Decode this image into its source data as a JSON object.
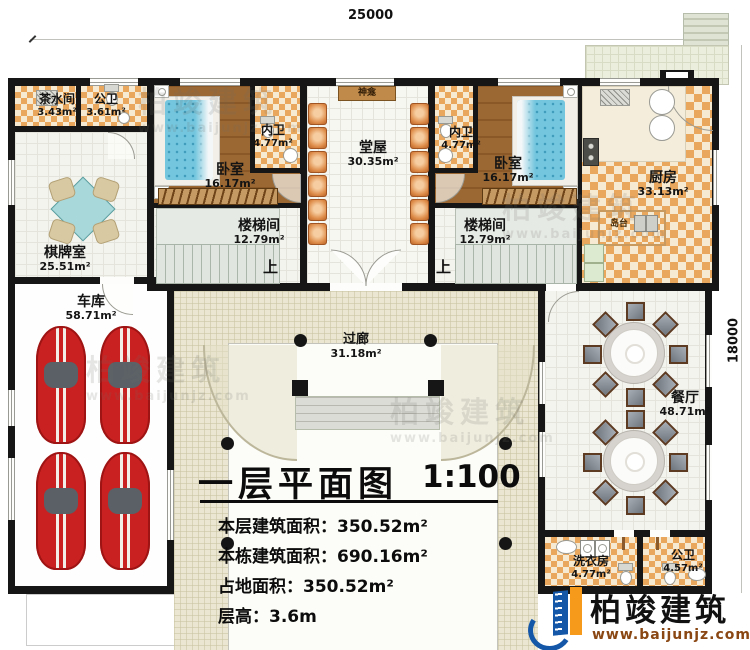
{
  "dimensions": {
    "width": "25000",
    "height": "18000"
  },
  "labels": {
    "up": "上"
  },
  "rooms": {
    "tea_room": {
      "name": "茶水间",
      "area": "3.43m²"
    },
    "public_wc_top": {
      "name": "公卫",
      "area": "3.61m²"
    },
    "chess_room": {
      "name": "棋牌室",
      "area": "25.51m²"
    },
    "garage": {
      "name": "车库",
      "area": "58.71m²"
    },
    "bedroom_left": {
      "name": "卧室",
      "area": "16.17m²"
    },
    "inner_wc_left": {
      "name": "内卫",
      "area": "4.77m²"
    },
    "stair_left": {
      "name": "楼梯间",
      "area": "12.79m²"
    },
    "hall": {
      "name": "堂屋",
      "area": "30.35m²"
    },
    "shrine": {
      "name": "神龛"
    },
    "inner_wc_right": {
      "name": "内卫",
      "area": "4.77m²"
    },
    "bedroom_right": {
      "name": "卧室",
      "area": "16.17m²"
    },
    "stair_right": {
      "name": "楼梯间",
      "area": "12.79m²"
    },
    "kitchen": {
      "name": "厨房",
      "area": "33.13m²"
    },
    "island": {
      "name": "岛台"
    },
    "corridor": {
      "name": "过廊",
      "area": "31.18m²"
    },
    "dining": {
      "name": "餐厅",
      "area": "48.71m²"
    },
    "laundry": {
      "name": "洗衣房",
      "area": "4.77m²"
    },
    "public_wc_bottom": {
      "name": "公卫",
      "area": "4.57m²"
    }
  },
  "title_block": {
    "title": "一层平面图",
    "scale": "1:100",
    "rows": [
      {
        "label": "本层建筑面积：",
        "value": "350.52m²"
      },
      {
        "label": "本栋建筑面积：",
        "value": "690.16m²"
      },
      {
        "label": "占地面积：",
        "value": "350.52m²"
      },
      {
        "label": "层高：",
        "value": "3.6m"
      }
    ]
  },
  "branding": {
    "company": "柏竣建筑",
    "website": "www.baijunjz.com"
  }
}
